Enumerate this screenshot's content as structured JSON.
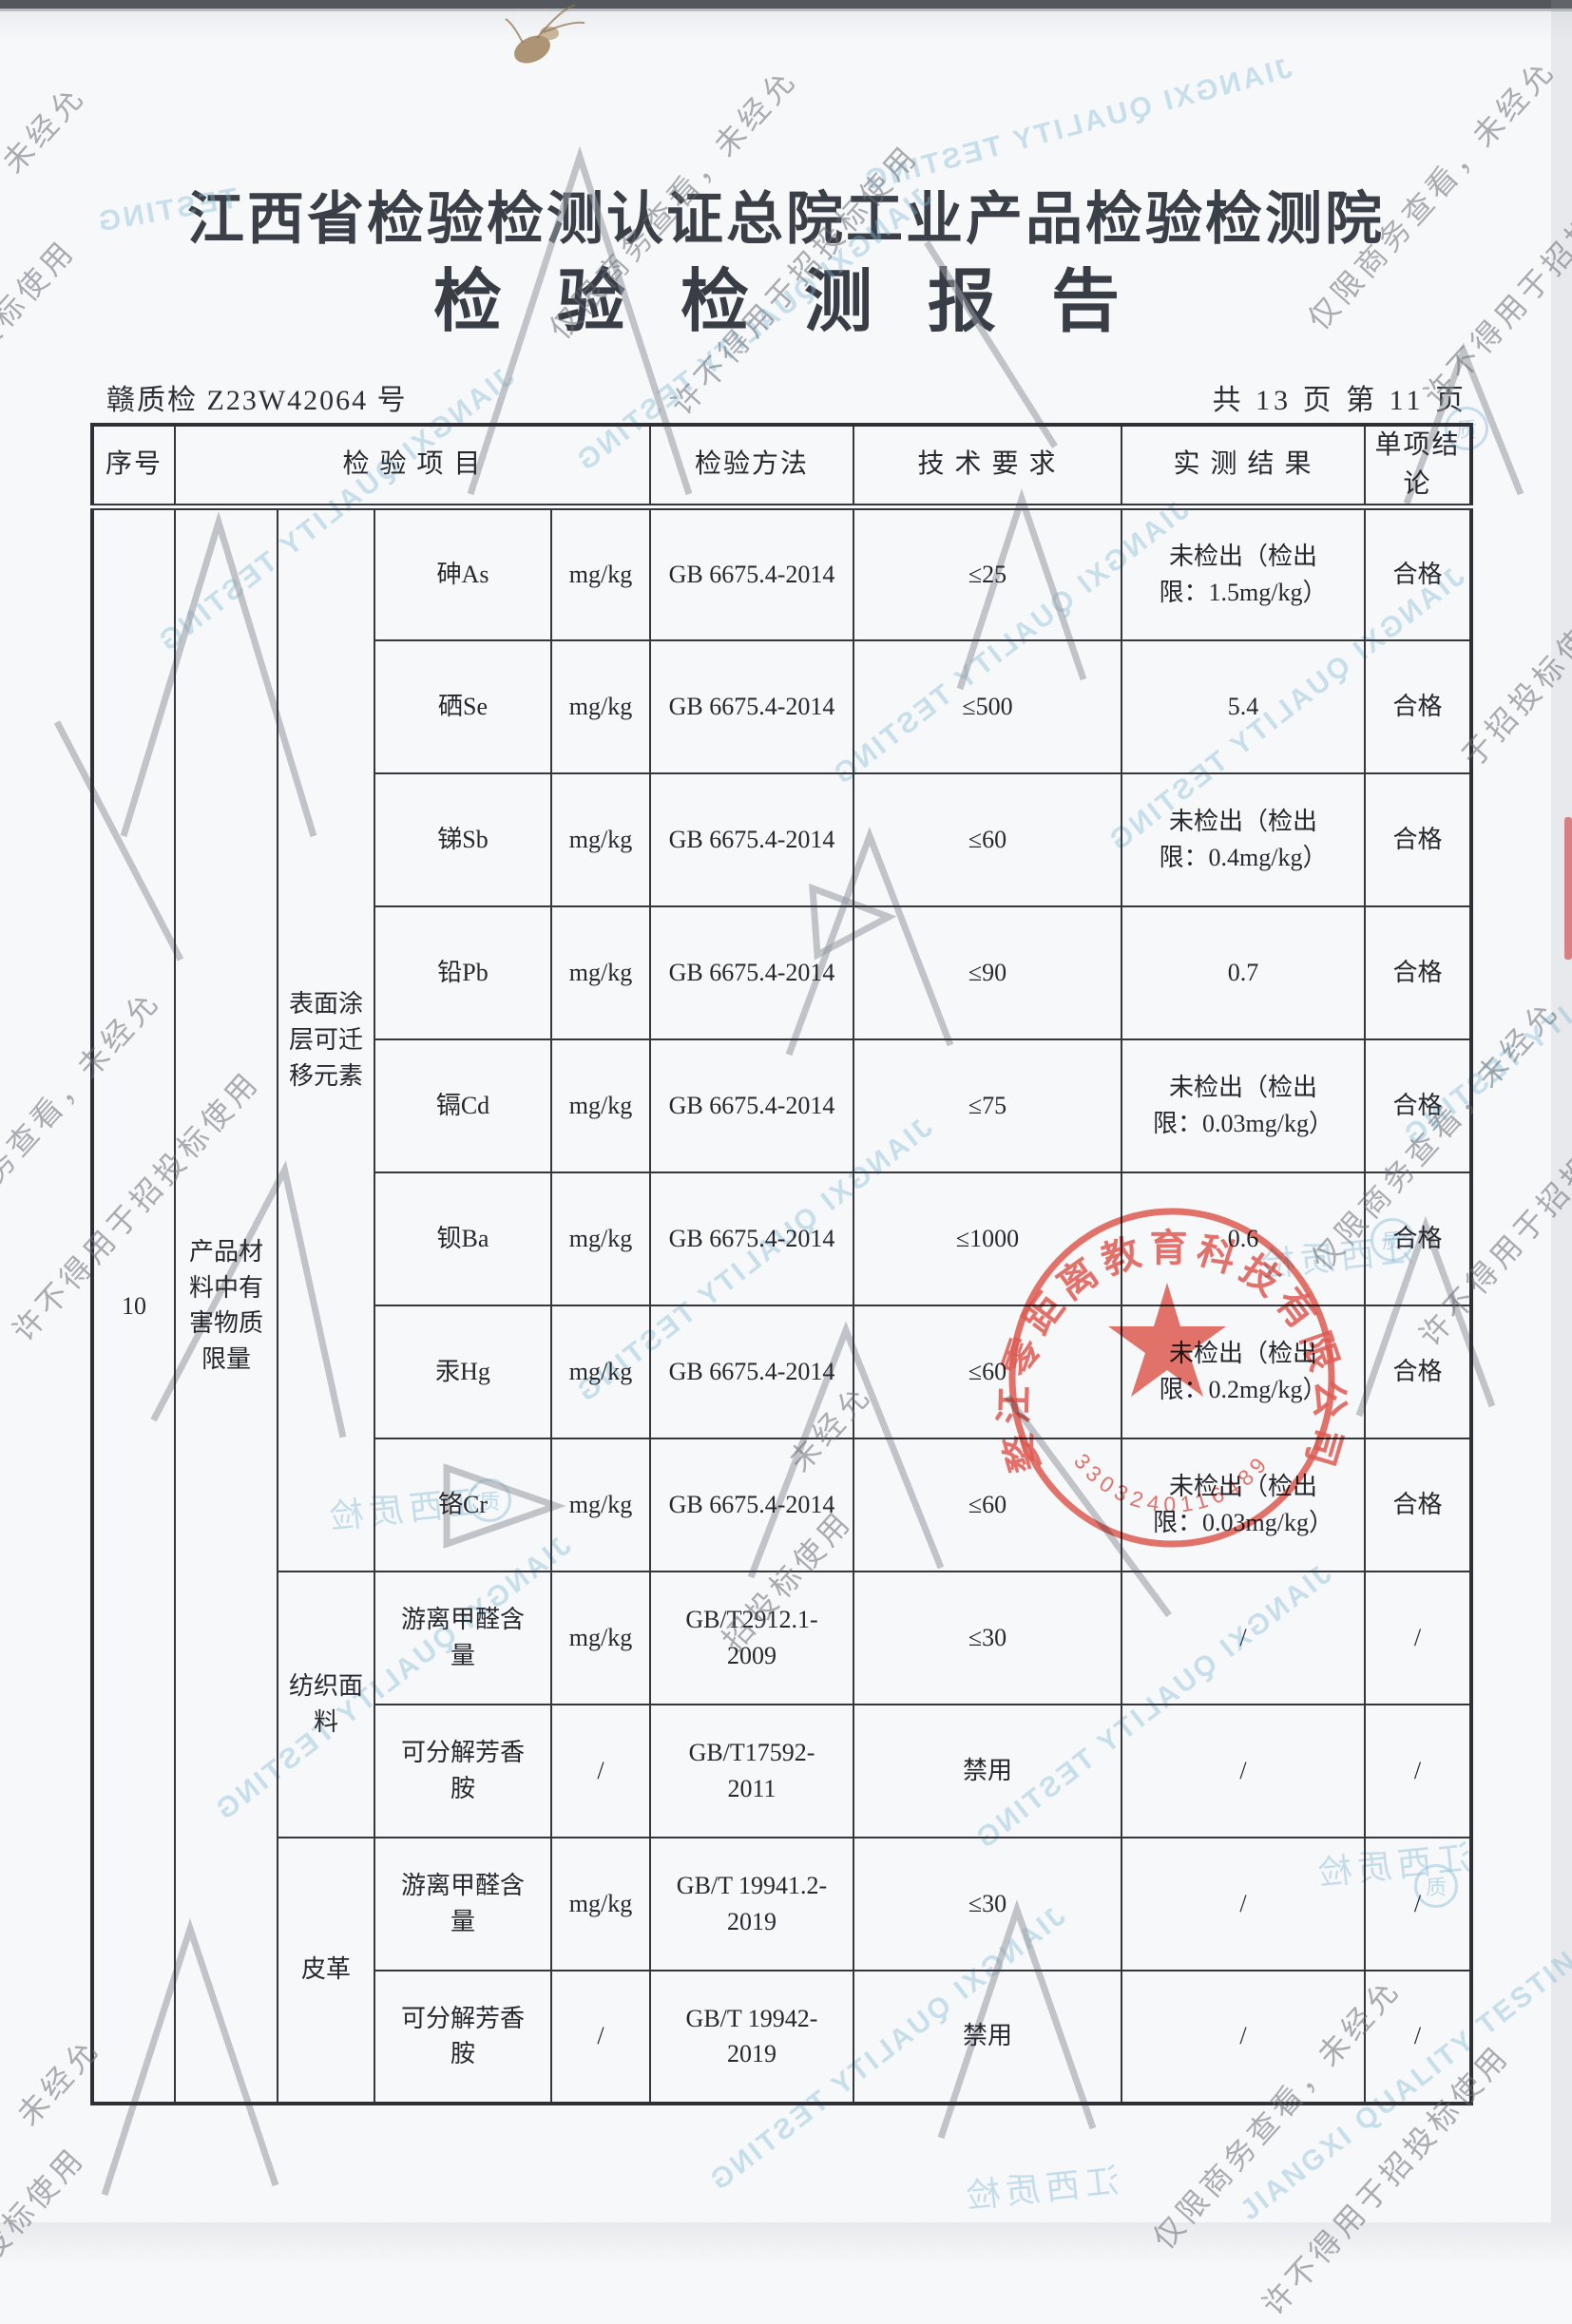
{
  "page": {
    "org_title": "江西省检验检测认证总院工业产品检验检测院",
    "report_title": "检 验 检 测 报 告",
    "report_no": "赣质检 Z23W42064 号",
    "page_info": "共 13 页 第 11 页"
  },
  "table": {
    "headers": {
      "seq": "序号",
      "item": "检 验 项 目",
      "method": "检验方法",
      "requirement": "技 术 要 求",
      "result": "实 测 结 果",
      "conclusion": "单项结论"
    },
    "seq_no": "10",
    "category": "产品材料中有害物质限量",
    "group1": "表面涂层可迁移元素",
    "group2": "纺织面料",
    "group3": "皮革",
    "rows": [
      {
        "item": "砷As",
        "unit": "mg/kg",
        "method": "GB 6675.4-2014",
        "requirement": "≤25",
        "result": "未检出（检出限：1.5mg/kg）",
        "conclusion": "合格"
      },
      {
        "item": "硒Se",
        "unit": "mg/kg",
        "method": "GB 6675.4-2014",
        "requirement": "≤500",
        "result": "5.4",
        "conclusion": "合格"
      },
      {
        "item": "锑Sb",
        "unit": "mg/kg",
        "method": "GB 6675.4-2014",
        "requirement": "≤60",
        "result": "未检出（检出限：0.4mg/kg）",
        "conclusion": "合格"
      },
      {
        "item": "铅Pb",
        "unit": "mg/kg",
        "method": "GB 6675.4-2014",
        "requirement": "≤90",
        "result": "0.7",
        "conclusion": "合格"
      },
      {
        "item": "镉Cd",
        "unit": "mg/kg",
        "method": "GB 6675.4-2014",
        "requirement": "≤75",
        "result": "未检出（检出限：0.03mg/kg）",
        "conclusion": "合格"
      },
      {
        "item": "钡Ba",
        "unit": "mg/kg",
        "method": "GB 6675.4-2014",
        "requirement": "≤1000",
        "result": "0.6",
        "conclusion": "合格"
      },
      {
        "item": "汞Hg",
        "unit": "mg/kg",
        "method": "GB 6675.4-2014",
        "requirement": "≤60",
        "result": "未检出（检出限：0.2mg/kg）",
        "conclusion": "合格"
      },
      {
        "item": "铬Cr",
        "unit": "mg/kg",
        "method": "GB 6675.4-2014",
        "requirement": "≤60",
        "result": "未检出（检出限：0.03mg/kg）",
        "conclusion": "合格"
      },
      {
        "item": "游离甲醛含量",
        "unit": "mg/kg",
        "method": "GB/T2912.1-2009",
        "requirement": "≤30",
        "result": "/",
        "conclusion": "/"
      },
      {
        "item": "可分解芳香胺",
        "unit": "/",
        "method": "GB/T17592-2011",
        "requirement": "禁用",
        "result": "/",
        "conclusion": "/"
      },
      {
        "item": "游离甲醛含量",
        "unit": "mg/kg",
        "method": "GB/T 19941.2-2019",
        "requirement": "≤30",
        "result": "/",
        "conclusion": "/"
      },
      {
        "item": "可分解芳香胺",
        "unit": "/",
        "method": "GB/T 19942-2019",
        "requirement": "禁用",
        "result": "/",
        "conclusion": "/"
      }
    ]
  },
  "stamp": {
    "company": "婺江零距离教育科技有限公司",
    "number": "3303240116489"
  },
  "watermarks": {
    "full": "仅限商务查看，未经允许不得用于招投标使用",
    "line1": "仅限商务查看，未经允",
    "line2": "许不得用于招投标使用",
    "frag_a": "看，未经允",
    "frag_b": "于招投标使用",
    "frag_c": "未经允",
    "frag_d": "招投标使用",
    "english": "JIANGXI QUALITY TESTING",
    "english_short": "TESTING",
    "cn_small": "江西质检"
  }
}
